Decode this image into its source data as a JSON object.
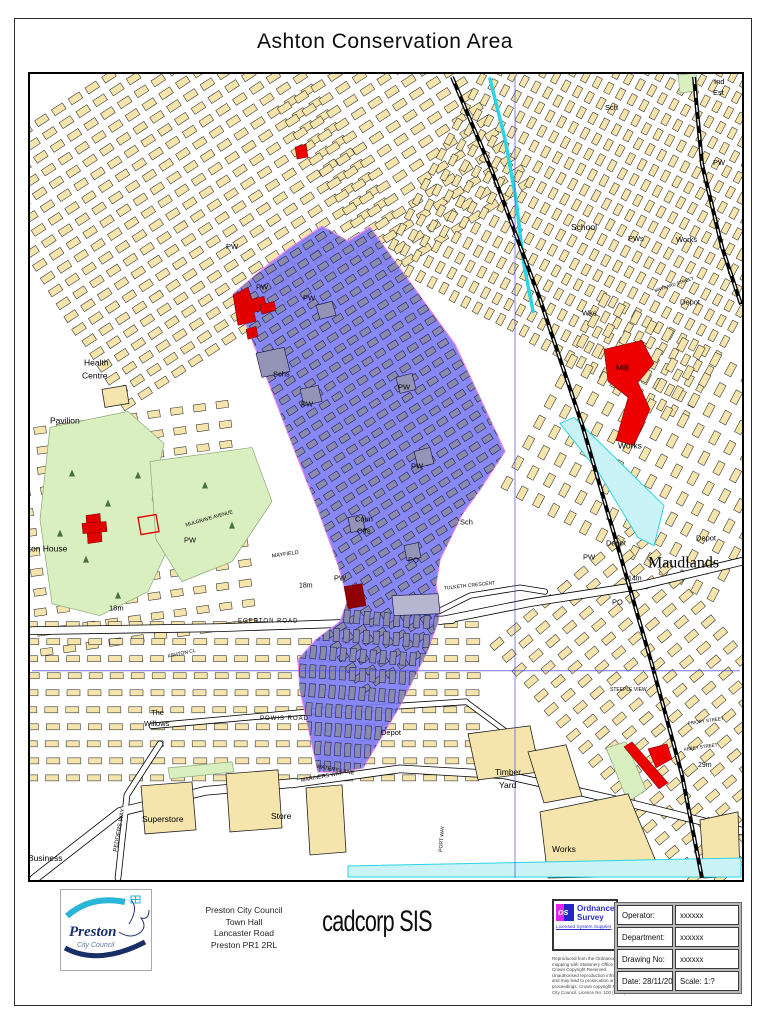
{
  "page": {
    "title": "Ashton Conservation Area"
  },
  "footer": {
    "logo": {
      "line1": "Preston",
      "line2": "City Council"
    },
    "address_lines": [
      "Preston City Council",
      "Town Hall",
      "Lancaster Road",
      "Preston PR1 2RL"
    ],
    "software": "cadcorp SIS",
    "os": {
      "abbr": "os",
      "line1": "Ordnance",
      "line2": "Survey",
      "tagline": "Licensed System Supplier"
    },
    "copyright_lines": [
      "Reproduced from the Ordnance Survey",
      "mapping with Stationery Office ©",
      "Crown Copyright Reserved.",
      "Unauthorised reproduction infringes",
      "and may lead to prosecution or civil",
      "proceedings. Crown copyright Preston",
      "City Council. Licence No. 100 (2008)"
    ],
    "table": {
      "rows": [
        {
          "label": "Operator:",
          "value": "xxxxxx"
        },
        {
          "label": "Department:",
          "value": "xxxxxx"
        },
        {
          "label": "Drawing No:",
          "value": "xxxxxx"
        }
      ],
      "date": "Date: 28/11/2008",
      "scale": "Scale: 1:?"
    }
  },
  "map": {
    "colors": {
      "area": "#7b7bf3",
      "area_border": "#ee82ee",
      "building": "#f5e5ad",
      "gray_block": "#8a8aae",
      "park": "#daefbf",
      "park_edge": "#8aa878",
      "water_fill": "#c9f3f6",
      "water_line": "#2cd4e4",
      "red": "#ec0000",
      "grid": "#5050e0"
    },
    "conservation_area": {
      "points": "233,295 260,272 288,250 322,227 348,242 370,228 415,290 455,345 505,452 480,490 462,515 440,560 436,585 440,610 438,622 428,650 400,706 363,768 340,772 318,772 300,690 298,660 316,640 340,622 348,600 338,565 318,510 295,452 272,392 250,335"
    },
    "fabric": [
      {
        "layer": "base",
        "x": 18,
        "y": 50,
        "w": 340,
        "h": 290,
        "a": -33,
        "bw": 13,
        "bh": 7,
        "gx": 7,
        "gy": 8,
        "f": "#f5e5ad",
        "s": "#2b2b2b"
      },
      {
        "layer": "base",
        "x": 320,
        "y": 45,
        "w": 175,
        "h": 210,
        "a": -33,
        "bw": 13,
        "bh": 7,
        "gx": 7,
        "gy": 8,
        "f": "#f5e5ad",
        "s": "#2b2b2b"
      },
      {
        "layer": "base",
        "x": 445,
        "y": 20,
        "w": 340,
        "h": 350,
        "a": -62,
        "bw": 11,
        "bh": 6,
        "gx": 6,
        "gy": 7,
        "f": "#f5e5ad",
        "s": "#2b2b2b"
      },
      {
        "layer": "base",
        "x": 555,
        "y": 330,
        "w": 210,
        "h": 250,
        "a": -62,
        "bw": 13,
        "bh": 7,
        "gx": 10,
        "gy": 11,
        "f": "#f5e5ad",
        "s": "#2b2b2b"
      },
      {
        "layer": "base",
        "x": 585,
        "y": 545,
        "w": 180,
        "h": 360,
        "a": -40,
        "bw": 13,
        "bh": 7,
        "gx": 9,
        "gy": 10,
        "f": "#f5e5ad",
        "s": "#2b2b2b"
      },
      {
        "layer": "base",
        "x": 25,
        "y": 415,
        "w": 220,
        "h": 230,
        "a": -8,
        "bw": 12,
        "bh": 7,
        "gx": 11,
        "gy": 13,
        "f": "#f5e5ad",
        "s": "#2b2b2b"
      },
      {
        "layer": "base",
        "x": 25,
        "y": 622,
        "w": 450,
        "h": 170,
        "a": 0,
        "bw": 13,
        "bh": 6,
        "gx": 8,
        "gy": 11,
        "f": "#f5e5ad",
        "s": "#2b2b2b"
      },
      {
        "layer": "ca",
        "clip": true,
        "x": 220,
        "y": 210,
        "w": 310,
        "h": 440,
        "a": -33,
        "bw": 10,
        "bh": 6,
        "gx": 5,
        "gy": 7,
        "f": "#8a8aae",
        "s": "#1c1c52"
      },
      {
        "layer": "ca",
        "clip": true,
        "x": 288,
        "y": 612,
        "w": 160,
        "h": 170,
        "a": 4,
        "bw": 6,
        "bh": 13,
        "gx": 4,
        "gy": 6,
        "f": "#8a8aae",
        "s": "#1c1c52"
      }
    ],
    "parks": [
      "50,428 128,412 164,444 152,500 172,540 148,592 100,616 52,604 40,520",
      "150,462 252,448 272,502 232,562 182,582 156,540",
      "606,748 626,742 646,790 628,802",
      "678,76 696,74 698,92 680,94",
      "168,768 232,762 234,772 170,779"
    ],
    "trees": [
      [
        72,
        470
      ],
      [
        108,
        500
      ],
      [
        86,
        556
      ],
      [
        138,
        472
      ],
      [
        118,
        592
      ],
      [
        205,
        482
      ],
      [
        232,
        522
      ],
      [
        60,
        530
      ]
    ],
    "roads": [
      {
        "pts": "32,631 220,628 452,620",
        "w": 7
      },
      {
        "pts": "440,621 530,603 640,586 741,562",
        "w": 7
      },
      {
        "pts": "152,726 310,712 466,702",
        "w": 5
      },
      {
        "pts": "292,784 400,769 505,775 620,801 741,831",
        "w": 7
      },
      {
        "pts": "34,879 120,812 205,791 295,783",
        "w": 8
      },
      {
        "pts": "118,878 127,795 160,744",
        "w": 5
      },
      {
        "pts": "466,702 520,742 560,770",
        "w": 4
      },
      {
        "pts": "428,617 470,596 520,588 545,592",
        "w": 4.5
      }
    ],
    "buildings_beige": [
      {
        "pts": "102,390 126,386 129,404 105,408"
      },
      {
        "pts": "141,786 192,782 196,830 145,834"
      },
      {
        "pts": "226,774 278,770 282,828 230,832"
      },
      {
        "pts": "306,788 342,785 346,852 310,855"
      },
      {
        "pts": "468,734 530,726 540,772 478,780"
      },
      {
        "pts": "528,752 566,745 582,796 544,803"
      },
      {
        "pts": "540,812 628,794 662,876 548,878"
      },
      {
        "pts": "700,820 738,812 740,876 704,878"
      }
    ],
    "buildings_gray": [
      {
        "pts": "256,354 284,348 290,372 262,378",
        "f": "#9494b6"
      },
      {
        "pts": "300,390 318,386 322,402 304,406",
        "f": "#9494b6"
      },
      {
        "pts": "316,306 332,302 336,316 320,320",
        "f": "#9494b6"
      },
      {
        "pts": "396,378 412,374 416,390 400,394",
        "f": "#9494b6"
      },
      {
        "pts": "414,452 430,448 434,464 418,468",
        "f": "#9494b6"
      },
      {
        "pts": "348,518 362,515 365,530 351,533",
        "f": "#9494b6"
      },
      {
        "pts": "404,546 418,543 421,558 407,561",
        "f": "#9494b6"
      },
      {
        "pts": "392,596 438,594 440,614 394,616",
        "f": "#b6b6d0"
      }
    ],
    "buildings_red": [
      {
        "pts": "233,296 248,288 252,300 264,297 267,310 254,313 256,322 238,326",
        "f": "#e00000"
      },
      {
        "pts": "260,306 274,302 276,311 262,315",
        "f": "#e00000"
      },
      {
        "pts": "246,330 256,327 258,337 248,340",
        "f": "#e00000"
      },
      {
        "pts": "86,516 100,514 102,542 88,544",
        "f": "#e00000"
      },
      {
        "pts": "82,524 106,522 107,532 83,534",
        "f": "#e00000"
      },
      {
        "pts": "138,518 156,515 159,532 141,535",
        "f": "none",
        "s": "#e00000",
        "sw": 1.3
      },
      {
        "pts": "344,587 362,584 366,606 348,609",
        "f": "#8f0000"
      },
      {
        "pts": "604,350 642,341 654,364 638,383 650,410 634,446 616,441 628,398 608,382",
        "f": "#ec0000"
      },
      {
        "pts": "624,747 632,742 668,783 659,789",
        "f": "#ec0000"
      },
      {
        "pts": "648,749 667,744 672,759 656,768",
        "f": "#ec0000"
      },
      {
        "pts": "295,148 306,145 308,158 297,160",
        "f": "#ec0000"
      }
    ],
    "water_polys": [
      "560,424 574,418 664,506 654,546 638,538 598,472",
      "348,866 741,858 741,877 348,877"
    ],
    "water_lines": [
      "490,80 505,140 516,200 523,260 533,312"
    ],
    "railways": [
      "452,78 492,172 540,300 582,425 618,548 652,665 682,775 702,878",
      "694,78 702,165 722,248 741,305"
    ],
    "gridlines": [
      "32,671 740,671",
      "515,77 515,878"
    ],
    "labels": [
      {
        "t": "e",
        "x": 20,
        "y": 436,
        "s": 15
      },
      {
        "t": "Health",
        "x": 84,
        "y": 366,
        "s": 8.5
      },
      {
        "t": "Centre",
        "x": 82,
        "y": 379,
        "s": 8.5
      },
      {
        "t": "Pavilion",
        "x": 50,
        "y": 424,
        "s": 8.5
      },
      {
        "t": "Ashton House",
        "x": 14,
        "y": 552,
        "s": 8.5
      },
      {
        "t": "18m",
        "x": 109,
        "y": 611,
        "s": 7.5
      },
      {
        "t": "The",
        "x": 151,
        "y": 715,
        "s": 7.5
      },
      {
        "t": "Willows",
        "x": 144,
        "y": 726,
        "s": 7.5
      },
      {
        "t": "Business",
        "x": 28,
        "y": 861,
        "s": 8.5
      },
      {
        "t": "PEDDERS WAY",
        "x": 117,
        "y": 852,
        "s": 6,
        "r": -80
      },
      {
        "t": "Superstore",
        "x": 142,
        "y": 822,
        "s": 8.5
      },
      {
        "t": "Store",
        "x": 271,
        "y": 819,
        "s": 8.5
      },
      {
        "t": "MARINERS WAY",
        "x": 301,
        "y": 782,
        "s": 5.5,
        "r": -10
      },
      {
        "t": "WATERY LANE",
        "x": 316,
        "y": 768,
        "s": 5.5,
        "r": 10
      },
      {
        "t": "POWIS ROAD",
        "x": 260,
        "y": 720,
        "s": 6,
        "ls": 1
      },
      {
        "t": "EGERTON ROAD",
        "x": 238,
        "y": 623,
        "s": 6,
        "ls": 1
      },
      {
        "t": "ASHTON CL",
        "x": 168,
        "y": 658,
        "s": 5,
        "r": -12
      },
      {
        "t": "MAYFIELD",
        "x": 272,
        "y": 558,
        "s": 5.5,
        "r": -8
      },
      {
        "t": "18m",
        "x": 299,
        "y": 588,
        "s": 7
      },
      {
        "t": "MULGRAVE AVENUE",
        "x": 186,
        "y": 527,
        "s": 5,
        "r": -16
      },
      {
        "t": "PW",
        "x": 184,
        "y": 543,
        "s": 7.5
      },
      {
        "t": "PW",
        "x": 226,
        "y": 250,
        "s": 7.5
      },
      {
        "t": "PW",
        "x": 256,
        "y": 290,
        "s": 7.5
      },
      {
        "t": "PW",
        "x": 303,
        "y": 301,
        "s": 7.5
      },
      {
        "t": "Schs",
        "x": 273,
        "y": 377,
        "s": 7.5
      },
      {
        "t": "PW",
        "x": 301,
        "y": 407,
        "s": 7.5
      },
      {
        "t": "PW",
        "x": 398,
        "y": 390,
        "s": 7.5
      },
      {
        "t": "PW",
        "x": 411,
        "y": 469,
        "s": 7.5
      },
      {
        "t": "Coun",
        "x": 355,
        "y": 522,
        "s": 7.5
      },
      {
        "t": "Offs",
        "x": 357,
        "y": 534,
        "s": 7.5
      },
      {
        "t": "PO",
        "x": 408,
        "y": 563,
        "s": 7.5
      },
      {
        "t": "Sch",
        "x": 460,
        "y": 525,
        "s": 7.5
      },
      {
        "t": "PW",
        "x": 334,
        "y": 581,
        "s": 7.5
      },
      {
        "t": "TULKETH CRESCENT",
        "x": 444,
        "y": 590,
        "s": 5,
        "r": -6
      },
      {
        "t": "Depot",
        "x": 381,
        "y": 735,
        "s": 7.5
      },
      {
        "t": "Timber",
        "x": 495,
        "y": 775,
        "s": 8.5
      },
      {
        "t": "Yard",
        "x": 499,
        "y": 788,
        "s": 8.5
      },
      {
        "t": "Works",
        "x": 552,
        "y": 852,
        "s": 8.5
      },
      {
        "t": "PORT WAY",
        "x": 442,
        "y": 852,
        "s": 5,
        "r": -85
      },
      {
        "t": "29m",
        "x": 698,
        "y": 767,
        "s": 7
      },
      {
        "t": "ABBEY STREET",
        "x": 684,
        "y": 751,
        "s": 4.5,
        "r": -8
      },
      {
        "t": "PRIORY STREET",
        "x": 688,
        "y": 725,
        "s": 4.5,
        "r": -8
      },
      {
        "t": "STEEPLE VIEW",
        "x": 610,
        "y": 691,
        "s": 5
      },
      {
        "t": "Maudlands",
        "x": 648,
        "y": 568,
        "s": 16,
        "f": "serif"
      },
      {
        "t": "PO",
        "x": 612,
        "y": 605,
        "s": 7.5
      },
      {
        "t": "14m",
        "x": 628,
        "y": 581,
        "s": 7
      },
      {
        "t": "PW",
        "x": 583,
        "y": 560,
        "s": 7.5
      },
      {
        "t": "Depot",
        "x": 606,
        "y": 546,
        "s": 7.5
      },
      {
        "t": "Depot",
        "x": 696,
        "y": 541,
        "s": 7.5
      },
      {
        "t": "Works",
        "x": 618,
        "y": 449,
        "s": 8.5
      },
      {
        "t": "Mill",
        "x": 616,
        "y": 371,
        "s": 8.5
      },
      {
        "t": "Wks",
        "x": 582,
        "y": 316,
        "s": 7.5
      },
      {
        "t": "Depot",
        "x": 680,
        "y": 305,
        "s": 7.5
      },
      {
        "t": "MAYNARD STREET",
        "x": 655,
        "y": 293,
        "s": 4.5,
        "r": -18
      },
      {
        "t": "Works",
        "x": 676,
        "y": 243,
        "s": 7.5
      },
      {
        "t": "PWs",
        "x": 628,
        "y": 242,
        "s": 7.5
      },
      {
        "t": "School",
        "x": 571,
        "y": 231,
        "s": 8.5
      },
      {
        "t": "Sch",
        "x": 605,
        "y": 111,
        "s": 7.5
      },
      {
        "t": "PW",
        "x": 713,
        "y": 166,
        "s": 7.5
      },
      {
        "t": "Ind",
        "x": 714,
        "y": 85,
        "s": 7.5
      },
      {
        "t": "Est",
        "x": 713,
        "y": 96,
        "s": 7.5
      }
    ]
  }
}
